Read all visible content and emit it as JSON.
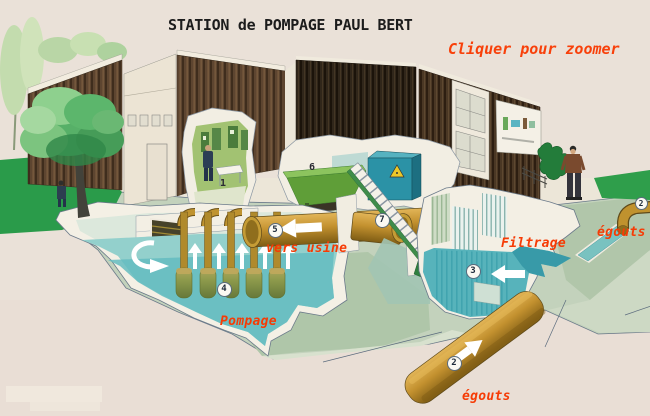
{
  "poster": {
    "title": "STATION de POMPAGE PAUL BERT",
    "zoom_hint": "Cliquer pour zoomer"
  },
  "labels": {
    "vers_usine": "vers usine",
    "filtrage": "Filtrage",
    "pompage": "Pompage",
    "egouts_inlet": "égouts",
    "egouts_outfall": "égouts"
  },
  "markers": {
    "control_room": "1",
    "sewer_inlet": "2",
    "filtration_basin": "3",
    "pump_group": "4",
    "discharge_pipe": "5",
    "refuse_skip": "6",
    "screenings_pipe": "7",
    "sewer_main": "2"
  },
  "colors": {
    "background_beige": "#eae1d8",
    "accent_red": "#f63b05",
    "title_black": "#1c1c1c",
    "water_teal": "#64bcc0",
    "pipe_ochre": "#c3912f",
    "grass_green": "#2a9b4a",
    "earth_sage": "#c3d2bc",
    "wall_brown": "#5d4530"
  }
}
